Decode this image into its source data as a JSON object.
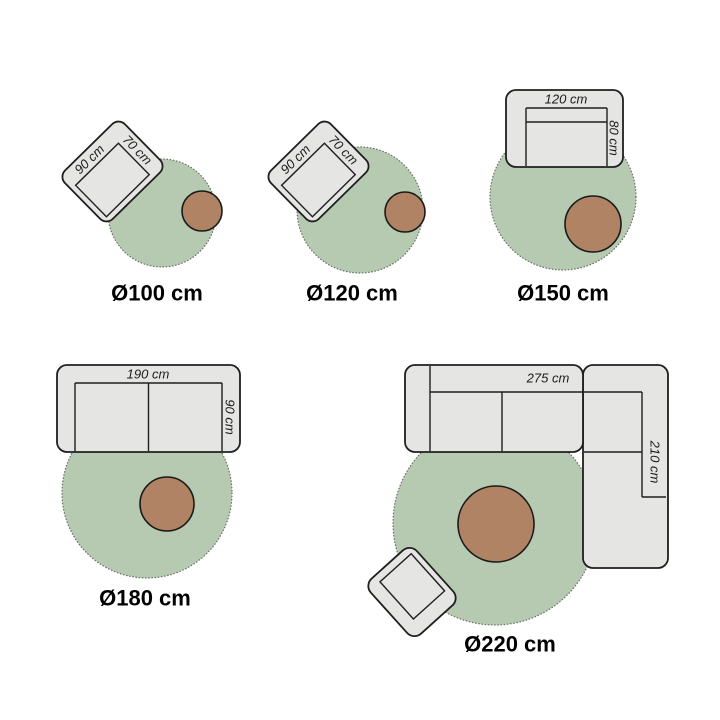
{
  "colors": {
    "background": "#ffffff",
    "rug_fill": "#b5cab0",
    "rug_edge": "#676f64",
    "furniture_fill": "#e5e5e4",
    "furniture_stroke": "#1f1f1f",
    "table_fill": "#b08365",
    "table_stroke": "#1a1a1a",
    "label_color": "#000000",
    "dim_color": "#1c1c1c"
  },
  "diagrams": [
    {
      "size_label": "Ø100 cm",
      "dim_width": "90 cm",
      "dim_depth": "70 cm"
    },
    {
      "size_label": "Ø120 cm",
      "dim_width": "90 cm",
      "dim_depth": "70 cm"
    },
    {
      "size_label": "Ø150 cm",
      "dim_width": "120 cm",
      "dim_depth": "80 cm"
    },
    {
      "size_label": "Ø180 cm",
      "dim_width": "190 cm",
      "dim_depth": "90 cm"
    },
    {
      "size_label": "Ø220 cm",
      "dim_width": "275 cm",
      "dim_depth": "210 cm"
    }
  ]
}
